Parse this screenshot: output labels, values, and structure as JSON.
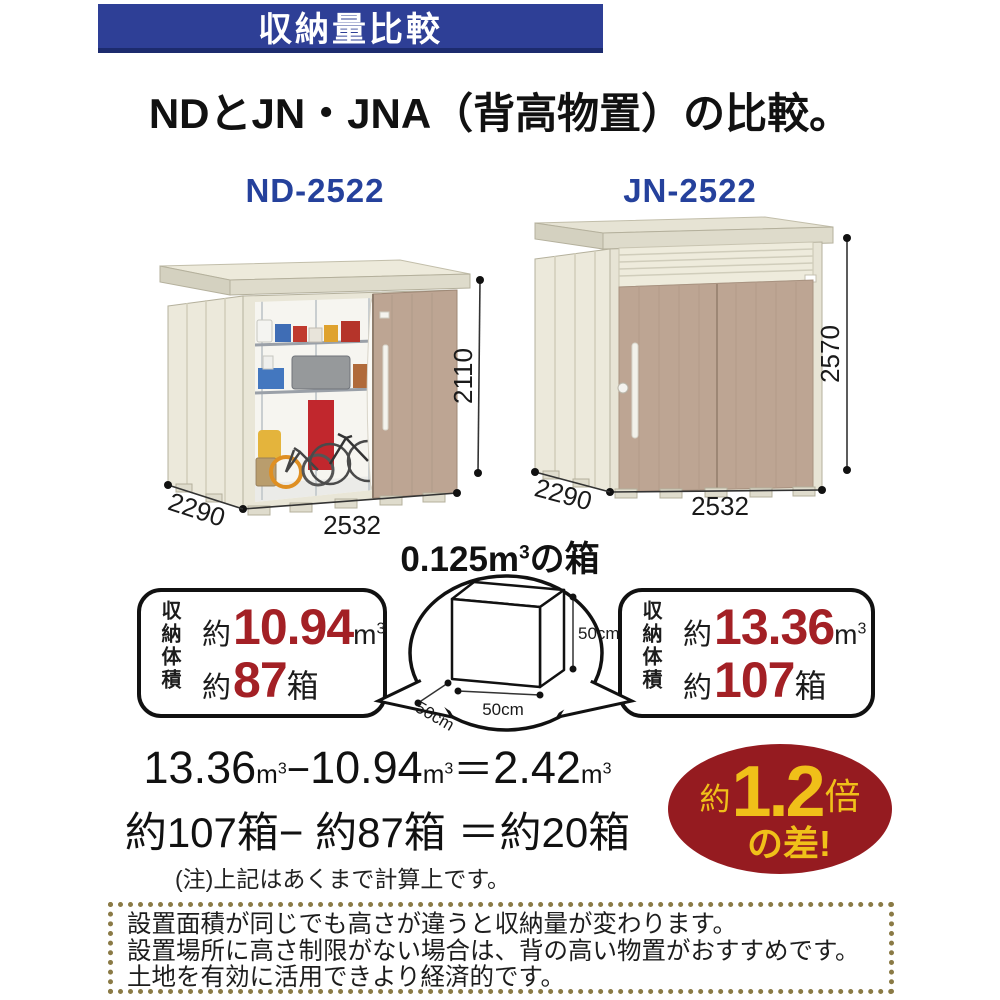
{
  "banner": {
    "title": "収納量比較"
  },
  "heading": "NDとJN・JNA（背高物置）の比較。",
  "sheds": {
    "left": {
      "label": "ND-2522",
      "width": "2532",
      "depth": "2290",
      "height": "2110"
    },
    "right": {
      "label": "JN-2522",
      "width": "2532",
      "depth": "2290",
      "height": "2570"
    }
  },
  "box_diagram": {
    "title": "0.125m",
    "title_sup": "3",
    "title_tail": "の箱",
    "dim": "50cm"
  },
  "capacity": {
    "left": {
      "label": "収納体積",
      "approx": "約",
      "volume": "10.94",
      "unit": "m",
      "unit_sup": "3",
      "count": "87",
      "count_unit": "箱"
    },
    "right": {
      "label": "収納体積",
      "approx": "約",
      "volume": "13.36",
      "unit": "m",
      "unit_sup": "3",
      "count": "107",
      "count_unit": "箱"
    }
  },
  "calculation": {
    "v1": "13.36",
    "v2": "10.94",
    "v3": "2.42",
    "unit": "m",
    "unit_sup": "3",
    "minus": "−",
    "equals": "＝",
    "line2": "約107箱− 約87箱 ＝約20箱",
    "note": "(注)上記はあくまで計算上です。"
  },
  "badge": {
    "approx": "約",
    "value": "1.2",
    "times": "倍",
    "line2": "の差!"
  },
  "footer": {
    "lines": [
      "設置面積が同じでも高さが違うと収納量が変わります。",
      "設置場所に高さ制限がない場合は、背の高い物置がおすすめです。",
      "土地を有効に活用できより経済的です。"
    ]
  },
  "colors": {
    "banner_bg": "#2e3f96",
    "label_blue": "#25419c",
    "accent_red": "#a32025",
    "badge_bg": "#951b20",
    "badge_text": "#f0c019",
    "door_tan": "#bda593",
    "panel_cream": "#eae7d8",
    "dotted_border": "#8a7a45"
  }
}
